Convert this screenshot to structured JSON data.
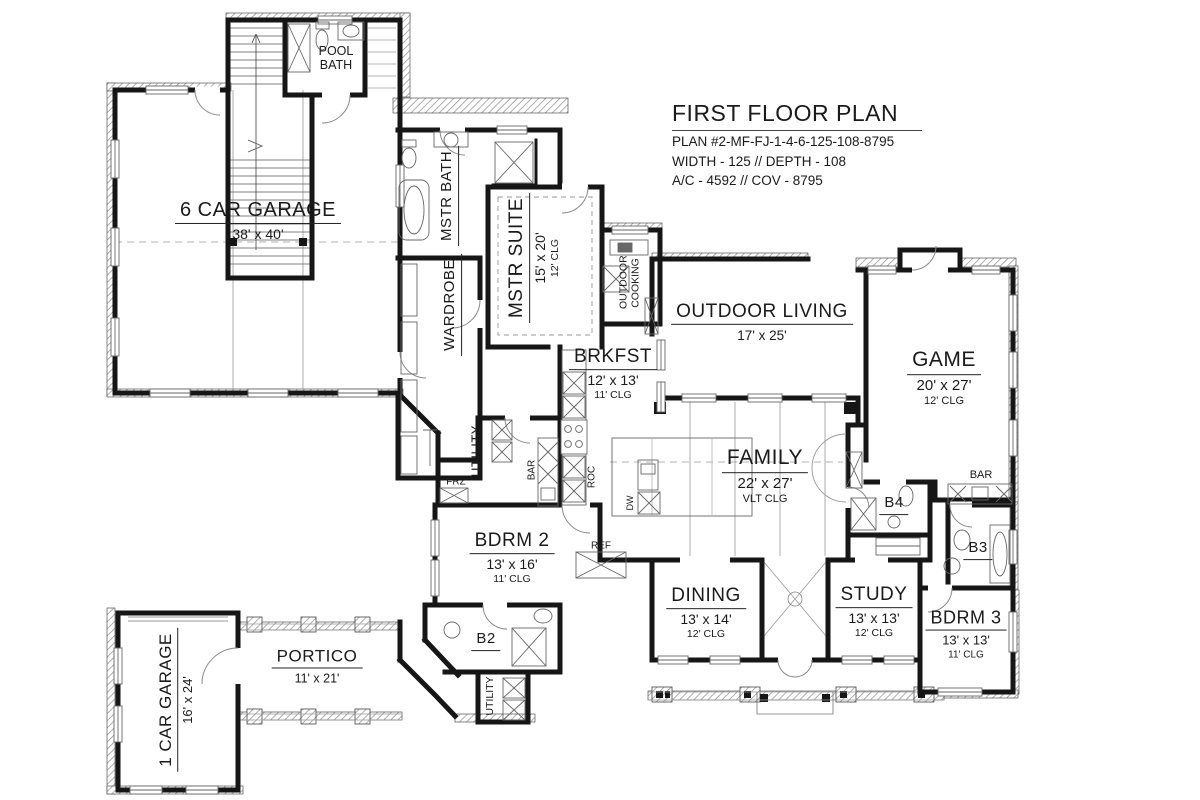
{
  "title_block": {
    "title": "FIRST FLOOR PLAN",
    "plan_number": "PLAN #2-MF-FJ-1-4-6-125-108-8795",
    "size_line": "WIDTH - 125 // DEPTH - 108",
    "area_line": "A/C - 4592 // COV - 8795"
  },
  "rooms": {
    "garage6": {
      "name": "6 CAR GARAGE",
      "dims": "38' x 40'"
    },
    "pool_bath": {
      "name": "POOL BATH"
    },
    "mstr_bath": {
      "name": "MSTR BATH"
    },
    "wardrobe": {
      "name": "WARDROBE"
    },
    "mstr_suite": {
      "name": "MSTR SUITE",
      "dims": "15' x 20'",
      "clg": "12' CLG"
    },
    "outdoor_cooking": {
      "name": "OUTDOOR COOKING"
    },
    "outdoor_living": {
      "name": "OUTDOOR LIVING",
      "dims": "17' x 25'"
    },
    "brkfst": {
      "name": "BRKFST",
      "dims": "12' x 13'",
      "clg": "11' CLG"
    },
    "game": {
      "name": "GAME",
      "dims": "20' x 27'",
      "clg": "12' CLG"
    },
    "family": {
      "name": "FAMILY",
      "dims": "22' x 27'",
      "clg": "VLT CLG"
    },
    "utility": {
      "name": "UTILITY"
    },
    "utility2": {
      "name": "UTILITY"
    },
    "frz": {
      "name": "FRZ"
    },
    "bar_kitchen": {
      "name": "BAR"
    },
    "roc": {
      "name": "ROC"
    },
    "dw": {
      "name": "DW"
    },
    "ref": {
      "name": "REF"
    },
    "bdrm2": {
      "name": "BDRM 2",
      "dims": "13' x 16'",
      "clg": "11' CLG"
    },
    "b2": {
      "name": "B2"
    },
    "b3": {
      "name": "B3"
    },
    "b4": {
      "name": "B4"
    },
    "bar_game": {
      "name": "BAR"
    },
    "dining": {
      "name": "DINING",
      "dims": "13' x 14'",
      "clg": "12' CLG"
    },
    "study": {
      "name": "STUDY",
      "dims": "13' x 13'",
      "clg": "12' CLG"
    },
    "bdrm3": {
      "name": "BDRM 3",
      "dims": "13' x 13'",
      "clg": "11' CLG"
    },
    "portico": {
      "name": "PORTICO",
      "dims": "11' x 21'"
    },
    "garage1": {
      "name": "1 CAR GARAGE",
      "dims": "16' x 24'"
    }
  },
  "colors": {
    "wall": "#161616",
    "thin_line": "#8a8a8a",
    "hatch": "#9a9a9a",
    "text": "#1a1a1a"
  }
}
